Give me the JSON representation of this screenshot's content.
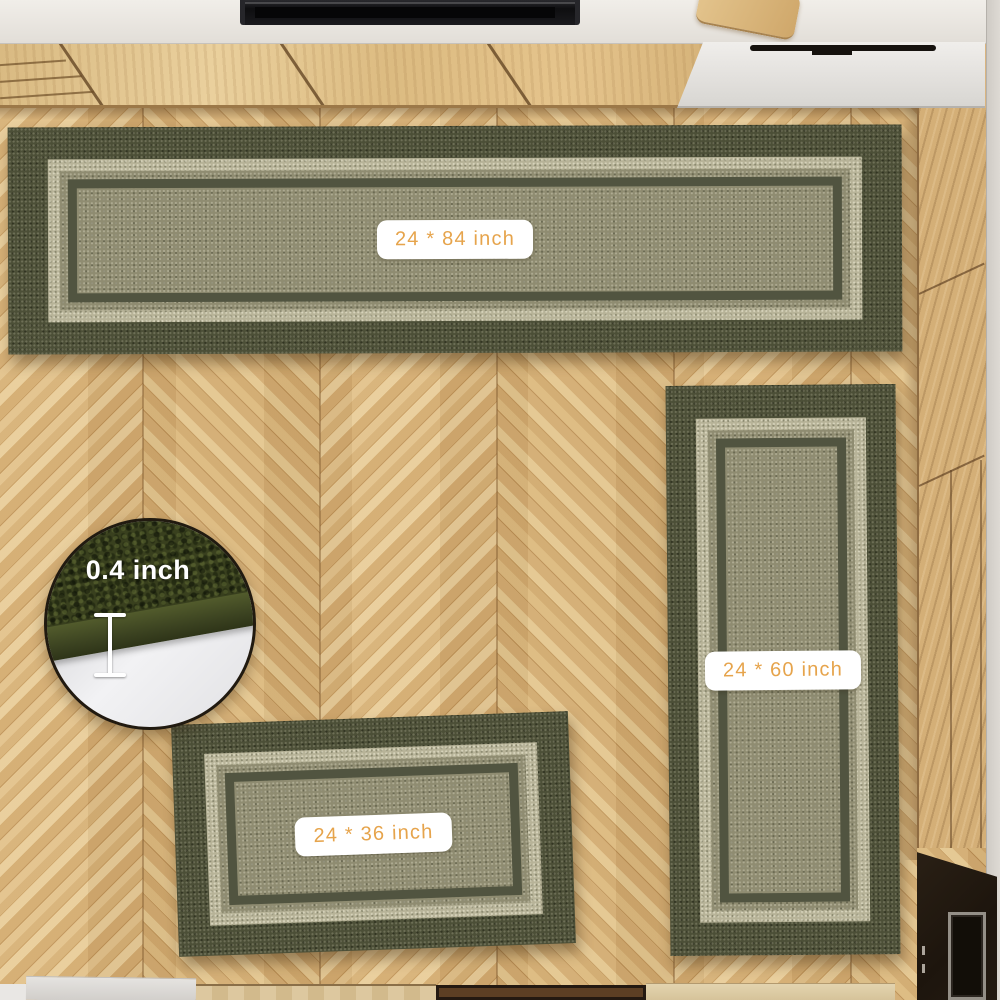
{
  "rugs": {
    "large": {
      "size_label": "24 * 84 inch"
    },
    "runner": {
      "size_label": "24 * 60 inch"
    },
    "small": {
      "size_label": "24 * 36 inch"
    }
  },
  "inset": {
    "thickness_label": "0.4 inch"
  },
  "colors": {
    "label_text": "#e6a44c",
    "label_bg": "#ffffff",
    "rug_border_dark": "#4c4f37",
    "rug_band_light": "#b7b398",
    "rug_field": "#8f8c71",
    "inset_rug_pile": "#39401e",
    "floor_wood": "#d9b480",
    "cabinet_wood": "#e0c18a",
    "countertop": "#ece8e2"
  }
}
